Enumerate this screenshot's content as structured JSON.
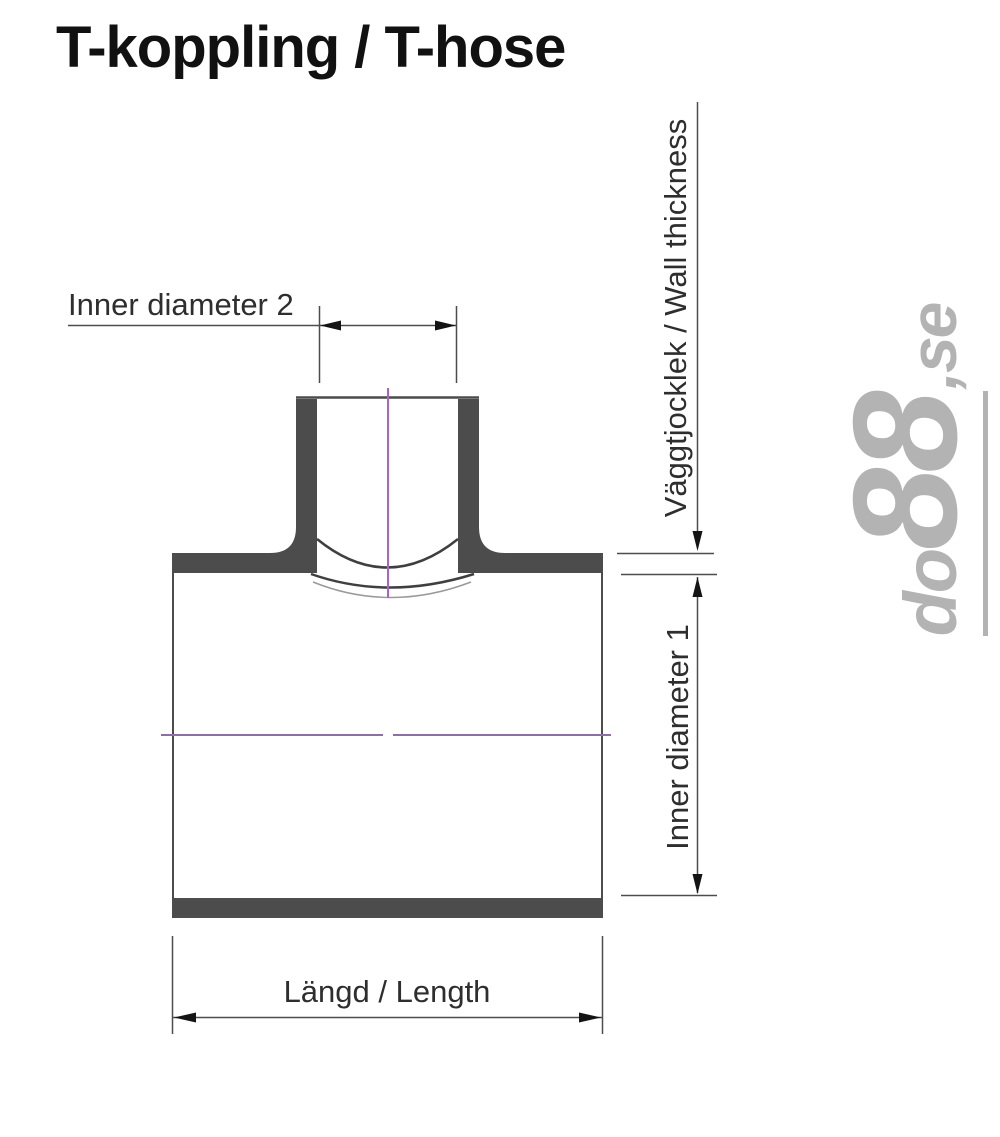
{
  "title": "T-koppling / T-hose",
  "labels": {
    "inner_diameter_2": "Inner diameter 2",
    "wall_thickness": "Väggtjocklek / Wall thickness",
    "inner_diameter_1": "Inner diameter 1",
    "length": "Längd / Length"
  },
  "watermark": {
    "prefix": "do",
    "numbers": "88",
    "suffix": ",se"
  },
  "colors": {
    "background": "#ffffff",
    "wall_fill": "#4c4c4c",
    "line": "#4d4d4d",
    "arrow": "#141414",
    "centerline_vertical": "#ad62c9",
    "centerline_horizontal": "#8d6fa3",
    "watermark": "#b3b3b3",
    "text": "#2e2e2e",
    "title": "#111111"
  }
}
